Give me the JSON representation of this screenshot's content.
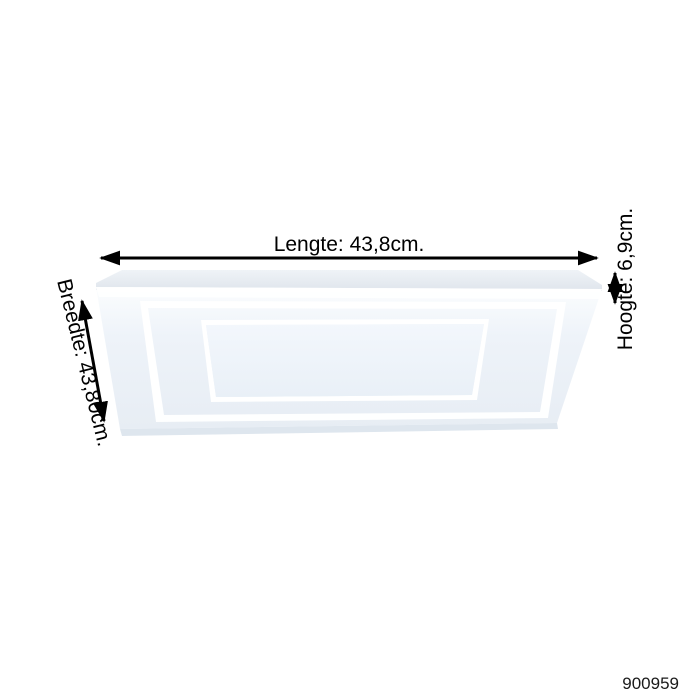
{
  "product": {
    "article_number": "900959",
    "dimensions": {
      "length_label": "Lengte: 43,8cm.",
      "width_label": "Breedte: 43,80cm.",
      "height_label": "Hoogte: 6,9cm.",
      "length_cm": "43,8",
      "width_cm": "43,80",
      "height_cm": "6,9"
    }
  },
  "colors": {
    "background": "#ffffff",
    "annotation": "#000000",
    "panel_back": "#e8edf2",
    "panel_face_top": "#fbfdfe",
    "panel_face_mid": "#eef3f9",
    "panel_face_bottom": "#e7edf4",
    "frame_white": "#ffffff",
    "panel_edge": "#dee6ee"
  }
}
